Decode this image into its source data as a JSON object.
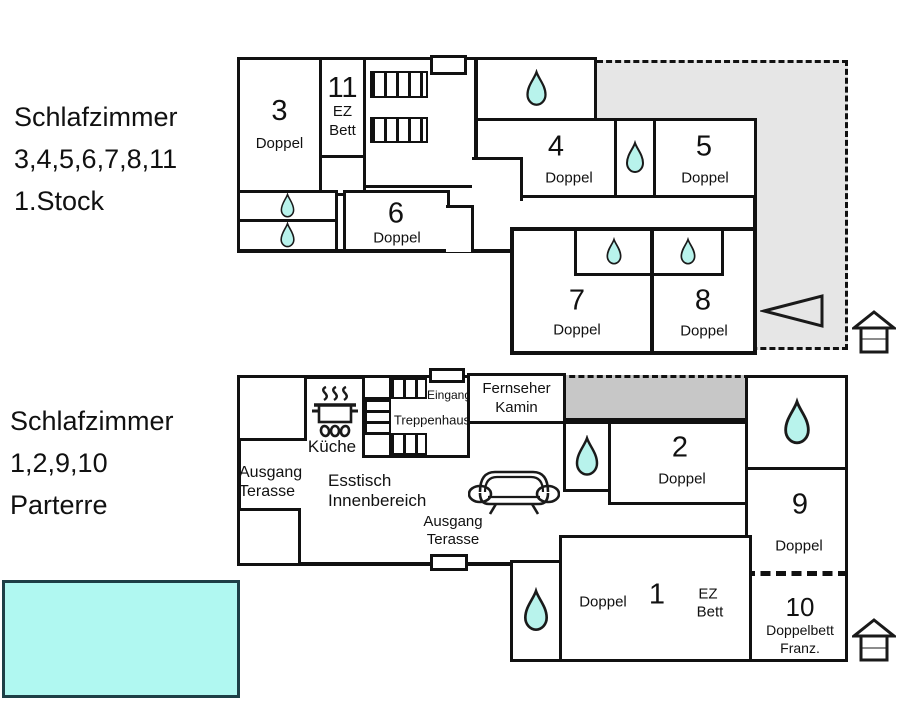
{
  "colors": {
    "wall": "#111111",
    "terrace": "#e6e6e6",
    "bar": "#c7c7c7",
    "drop-fill": "#b8f3ec",
    "drop-stroke": "#1a1a1a",
    "pool-fill": "#b0f8f1",
    "pool-border": "#1d3f46"
  },
  "title_floor1": {
    "line1": "Schlafzimmer",
    "line2": "3,4,5,6,7,8,11",
    "line3": "1.Stock"
  },
  "title_floor0": {
    "line1": "Schlafzimmer",
    "line2": "1,2,9,10",
    "line3": "Parterre"
  },
  "floor1": {
    "room3": {
      "num": "3",
      "type": "Doppel"
    },
    "room11": {
      "num": "11",
      "type_line1": "EZ",
      "type_line2": "Bett"
    },
    "room4": {
      "num": "4",
      "type": "Doppel"
    },
    "room5": {
      "num": "5",
      "type": "Doppel"
    },
    "room6": {
      "num": "6",
      "type": "Doppel"
    },
    "room7": {
      "num": "7",
      "type": "Doppel"
    },
    "room8": {
      "num": "8",
      "type": "Doppel"
    }
  },
  "floor0": {
    "eingang": "Eingang",
    "treppenhaus": "Treppenhaus",
    "kueche": "Küche",
    "fernseher_line1": "Fernseher",
    "fernseher_line2": "Kamin",
    "ausgang_left_line1": "Ausgang",
    "ausgang_left_line2": "Terasse",
    "esstisch_line1": "Esstisch",
    "esstisch_line2": "Innenbereich",
    "ausgang_mid_line1": "Ausgang",
    "ausgang_mid_line2": "Terasse",
    "room1": {
      "num": "1",
      "type_left": "Doppel",
      "type_right_line1": "EZ",
      "type_right_line2": "Bett"
    },
    "room2": {
      "num": "2",
      "type": "Doppel"
    },
    "room9": {
      "num": "9",
      "type": "Doppel"
    },
    "room10": {
      "num": "10",
      "type_line1": "Doppelbett",
      "type_line2": "Franz."
    }
  },
  "icons": {
    "water-drop": "bath / shower",
    "stove": "kitchen stove",
    "sofa": "sofa",
    "house-upper": "upper floor indicator",
    "house-ground": "ground floor indicator",
    "arrow-left": "direction arrow"
  }
}
